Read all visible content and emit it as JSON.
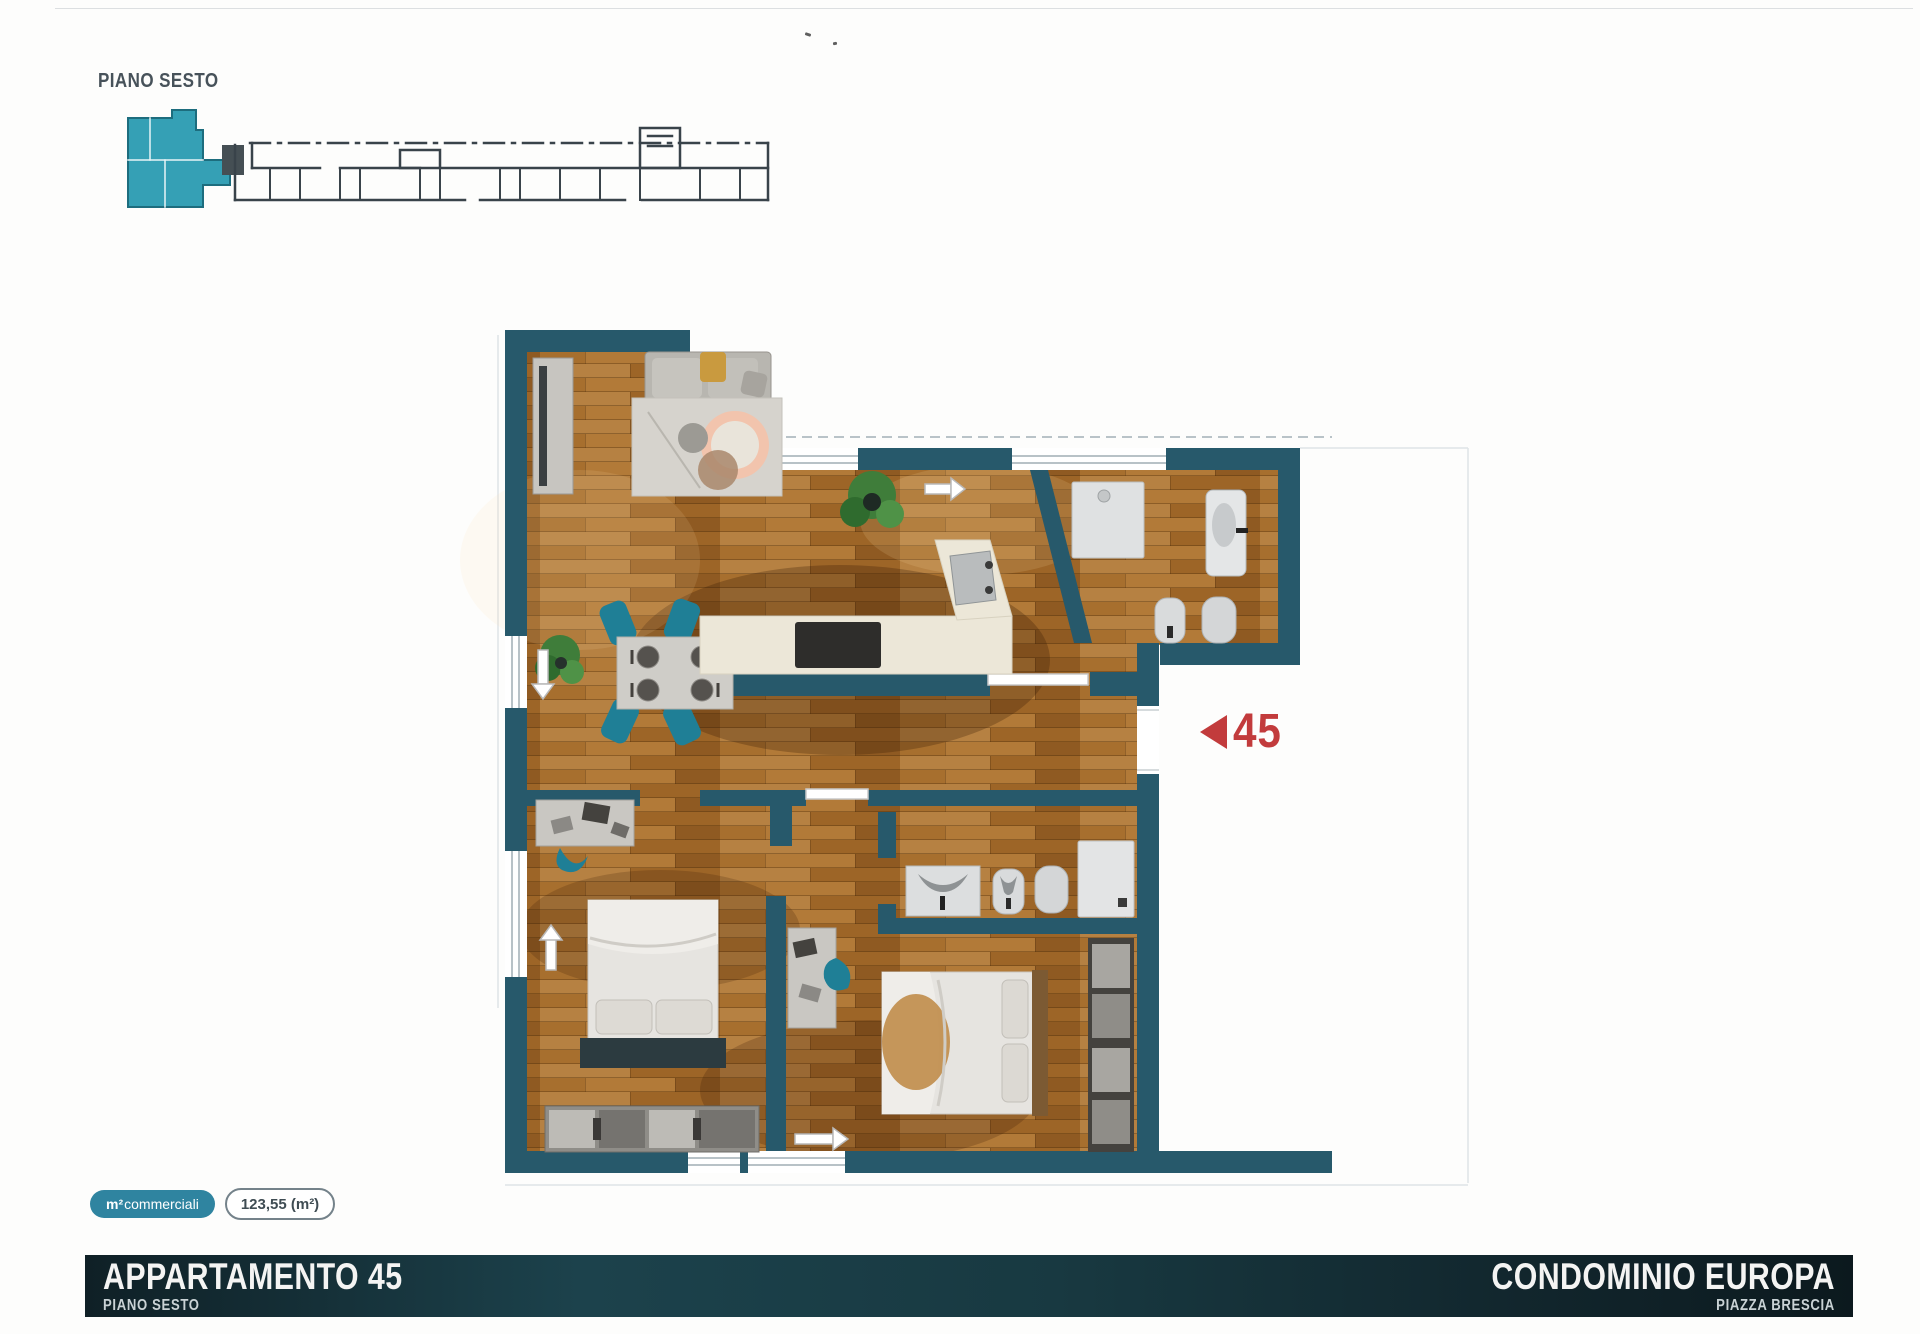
{
  "header": {
    "floor_label": "PIANO SESTO"
  },
  "key_plan": {
    "description": "building key plan with highlighted unit",
    "unit_color": "#35a0b5"
  },
  "plan": {
    "unit_number": "45",
    "marker_color": "#c23b3c",
    "wall_color": "#27596b",
    "wood_color": "#a9742f"
  },
  "area_badges": {
    "commercial_prefix": "m²",
    "commercial_label": "commerciali",
    "area_value": "123,55 (m²)"
  },
  "footer": {
    "title": "APPARTAMENTO 45",
    "subtitle": "PIANO SESTO",
    "project": "CONDOMINIO EUROPA",
    "location": "PIAZZA BRESCIA"
  }
}
